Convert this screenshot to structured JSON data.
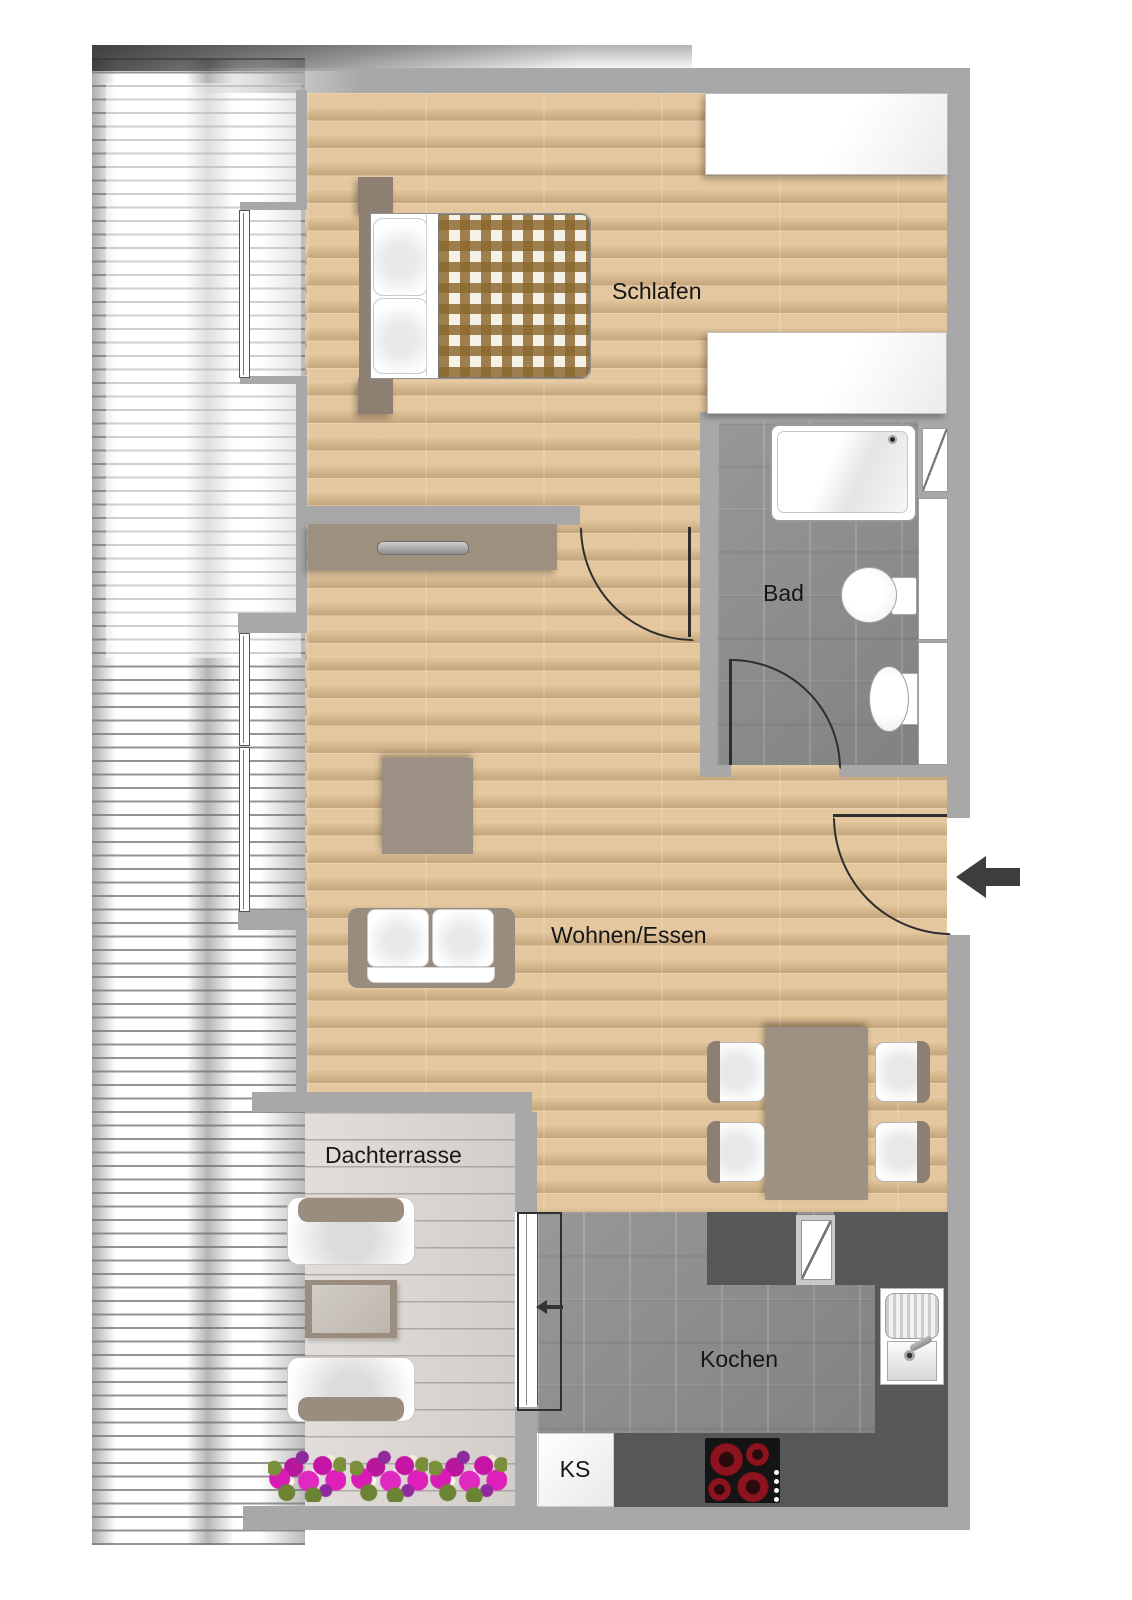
{
  "title": "Apartment floor plan (penthouse with roof terrace)",
  "rooms": {
    "bedroom": {
      "label": "Schlafen"
    },
    "bathroom": {
      "label": "Bad"
    },
    "living": {
      "label": "Wohnen/Essen"
    },
    "terrace": {
      "label": "Dachterrasse"
    },
    "kitchen": {
      "label": "Kochen"
    },
    "fridge": {
      "label": "KS"
    }
  },
  "icons": {
    "entrance_arrow": "left-arrow-entrance",
    "sliding_door_arrow": "left-arrow-sliding-door"
  },
  "colors": {
    "wall": "#a8a8a8",
    "wood_floor": "#e4c79e",
    "bath_kitchen_tile": "#8f918f",
    "kitchen_counter": "#565758",
    "terrace_deck": "#dcd6d2",
    "furniture_taupe": "#9c8f81",
    "duvet_check_brown": "#8a6730",
    "burner_red": "#8d141f",
    "flower_pink": "#d81bb4",
    "flower_leaf_green": "#7a8f3a",
    "door_swing_line": "#2e2e2e",
    "entrance_arrow_gray": "#3d3d3d",
    "label_text": "#161616"
  }
}
